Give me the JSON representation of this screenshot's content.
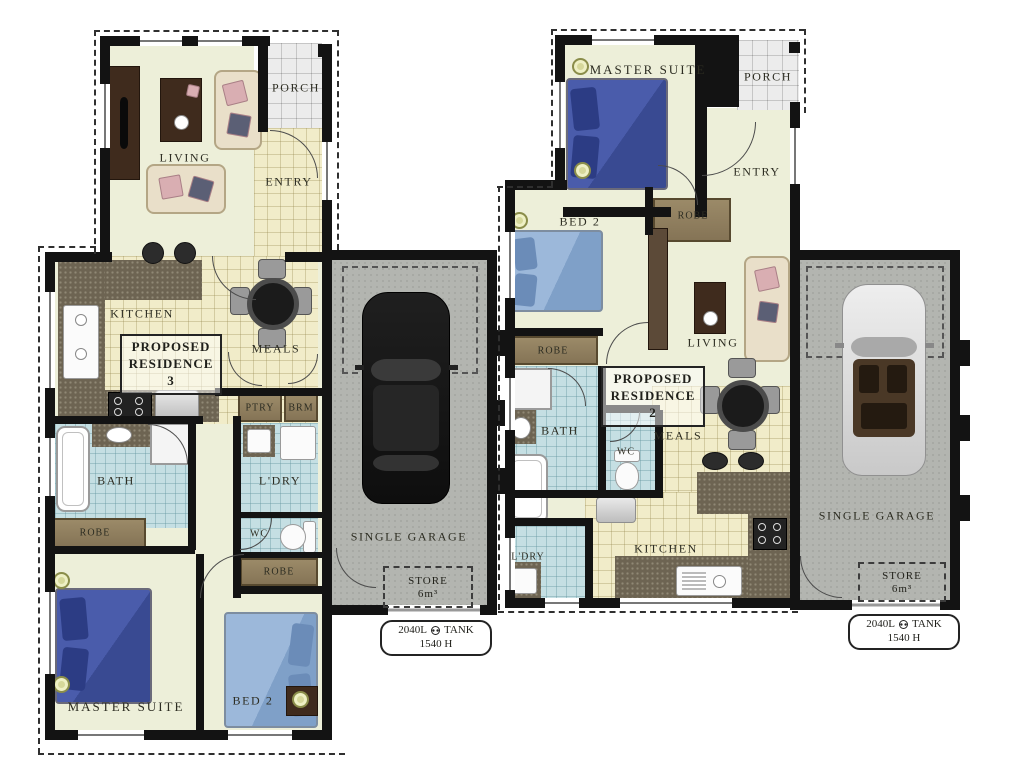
{
  "colors": {
    "wall": "#131313",
    "floor_cream": "#edefd9",
    "floor_tile": "#f1ecc9",
    "floor_wet": "#c5dfe3",
    "floor_porch": "#ececec",
    "floor_garage": "#b3b5b0",
    "counter": "#6d6452",
    "robe_wood": "#8d7c5e",
    "bed_dark": "#42539e",
    "bed_light": "#8fb0d6",
    "label_text": "#2d2d22"
  },
  "res3": {
    "title1": "PROPOSED",
    "title2": "RESIDENCE 3",
    "living": "LIVING",
    "porch": "PORCH",
    "entry": "ENTRY",
    "kitchen": "KITCHEN",
    "meals": "MEALS",
    "ptry": "PTRY",
    "brm": "BRM",
    "bath": "BATH",
    "ldry": "L'DRY",
    "robe_bath": "ROBE",
    "wc": "WC",
    "robe_bed2": "ROBE",
    "master": "MASTER SUITE",
    "bed2": "BED 2",
    "garage": "SINGLE GARAGE",
    "store": "STORE",
    "store_vol": "6m³",
    "tank_cap": "2040L",
    "tank_word": "TANK",
    "tank_height": "1540 H"
  },
  "res2": {
    "title1": "PROPOSED",
    "title2": "RESIDENCE 2",
    "master": "MASTER SUITE",
    "porch": "PORCH",
    "entry": "ENTRY",
    "robe_entry": "ROBE",
    "bed2": "BED 2",
    "living": "LIVING",
    "robe_bed2": "ROBE",
    "bath": "BATH",
    "wc": "WC",
    "meals": "MEALS",
    "ldry": "L'DRY",
    "kitchen": "KITCHEN",
    "garage": "SINGLE GARAGE",
    "store": "STORE",
    "store_vol": "6m³",
    "tank_cap": "2040L",
    "tank_word": "TANK",
    "tank_height": "1540 H"
  }
}
